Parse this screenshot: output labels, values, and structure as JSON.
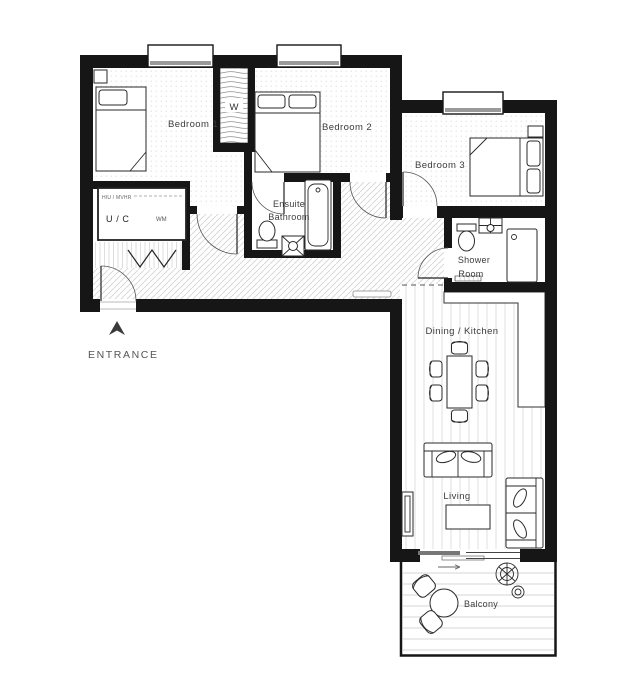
{
  "plan": {
    "entrance_label": "ENTRANCE",
    "rooms": {
      "bedroom1": "Bedroom 1",
      "bedroom2": "Bedroom 2",
      "bedroom3": "Bedroom 3",
      "ensuite_line1": "Ensuite",
      "ensuite_line2": "Bathroom",
      "shower_line1": "Shower",
      "shower_line2": "Room",
      "dining": "Dining / Kitchen",
      "living": "Living",
      "balcony": "Balcony",
      "wardrobe": "W",
      "utility": "U / C",
      "utility_sub": "HIU / MVHR",
      "washing_machine": "WM"
    },
    "colors": {
      "wall": "#161616",
      "label": "#3c3c3c",
      "hatch": "#c9c9c9"
    }
  }
}
